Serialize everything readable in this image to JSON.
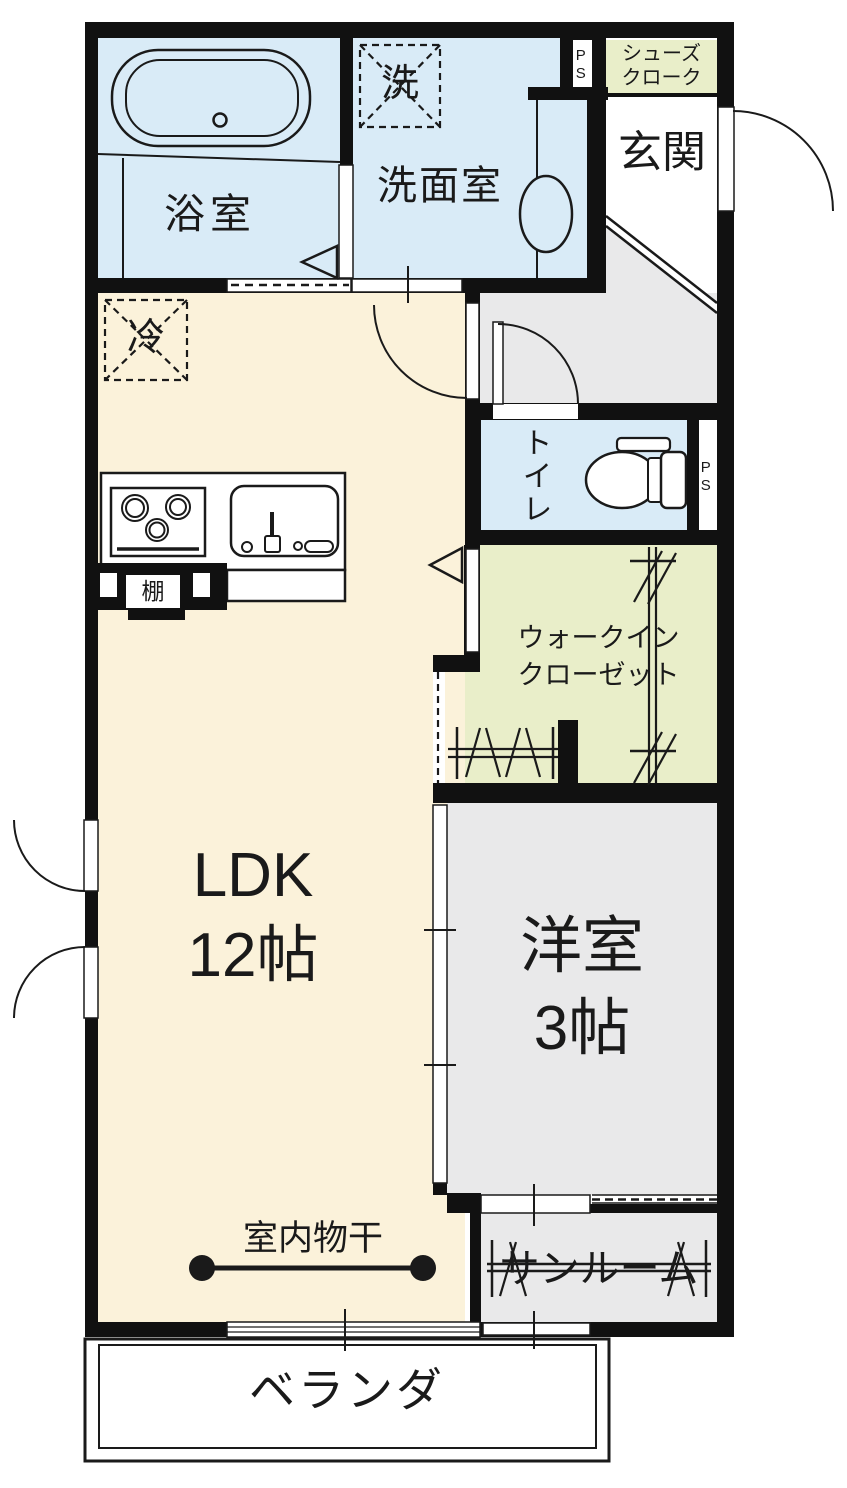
{
  "title": "apartment-floor-plan",
  "palette": {
    "wall": "#111111",
    "water_room_blue": "#d9ebf7",
    "ldk_cream": "#fbf2da",
    "closet_green": "#e9eec9",
    "hall_gray": "#e9e9ea",
    "line_black": "#1a1a1a",
    "floor_white": "#ffffff"
  },
  "rooms": {
    "bathroom": {
      "label": "浴室"
    },
    "washroom": {
      "label": "洗面室"
    },
    "entrance": {
      "label": "玄関"
    },
    "shoe_closet": {
      "line1": "シューズ",
      "line2": "クローク"
    },
    "toilet": {
      "label": "トイレ"
    },
    "walk_in_closet": {
      "line1": "ウォークイン",
      "line2": "クローゼット"
    },
    "ldk": {
      "line1": "LDK",
      "line2": "12帖"
    },
    "western_room": {
      "line1": "洋室",
      "line2": "3帖"
    },
    "sunroom": {
      "label": "サンルーム"
    },
    "veranda": {
      "label": "ベランダ"
    }
  },
  "annotations": {
    "pipe_space_top": "PS",
    "pipe_space_toilet": "PS",
    "refrigerator": "冷",
    "washing_machine": "洗",
    "shelf": "棚",
    "indoor_drying": "室内物干"
  }
}
